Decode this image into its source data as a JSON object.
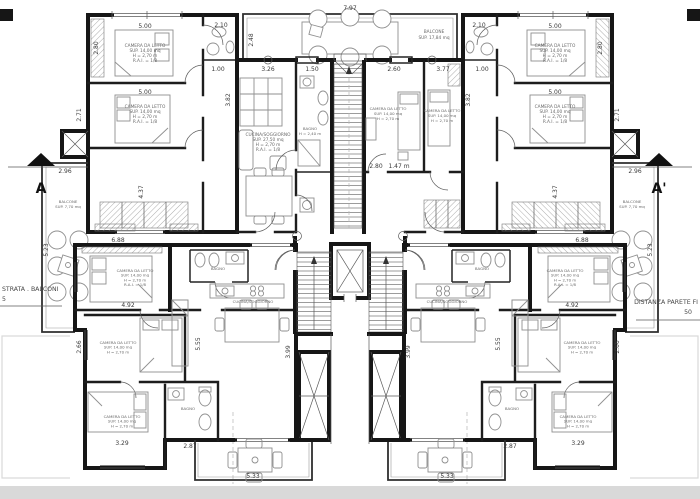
{
  "plan": {
    "markers": {
      "left": "A",
      "right": "A'"
    },
    "notes": {
      "left_l1": "STRATA . BALCONI",
      "left_l2": "5",
      "right_l1": "DISTANZA PARETE FI",
      "right_l2": "50"
    },
    "labels": {
      "bedroom": {
        "l1": "CAMERA DA LETTO",
        "l2": "SUP. 14,00 mq",
        "l3": "H = 2,70 m",
        "l4": "R.A.I. = 1/8"
      },
      "living": {
        "l1": "CUCINA/SOGGIORNO",
        "l2": "SUP. 27,50 mq",
        "l3": "H = 2,70 m",
        "l4": "R.A.I. = 1/8"
      },
      "bath": {
        "l1": "BAGNO",
        "l2": "H = 2,40 m"
      },
      "balcony_top": {
        "l1": "BALCONE",
        "l2": "SUP. 17,84 mq"
      },
      "balcony_side": {
        "l1": "BALCONE",
        "l2": "SUP. 7,70 mq"
      }
    },
    "dims": {
      "a500": "5.00",
      "a210": "2.10",
      "a100": "1.00",
      "a382": "3.82",
      "a280": "2.80",
      "a271": "2.71",
      "a437": "4.37",
      "a797": "7.97",
      "a248": "2.48",
      "a326": "3.26",
      "a150": "1.50",
      "a260": "2.60",
      "a377": "3.77",
      "a147": "1.47 m",
      "a296": "2.96",
      "a523": "5.23",
      "a688": "6.88",
      "a492": "4.92",
      "a266": "2.66",
      "a555": "5.55",
      "a399": "3.99",
      "a329": "3.29",
      "a287": "2.87",
      "a533": "5.33"
    }
  }
}
